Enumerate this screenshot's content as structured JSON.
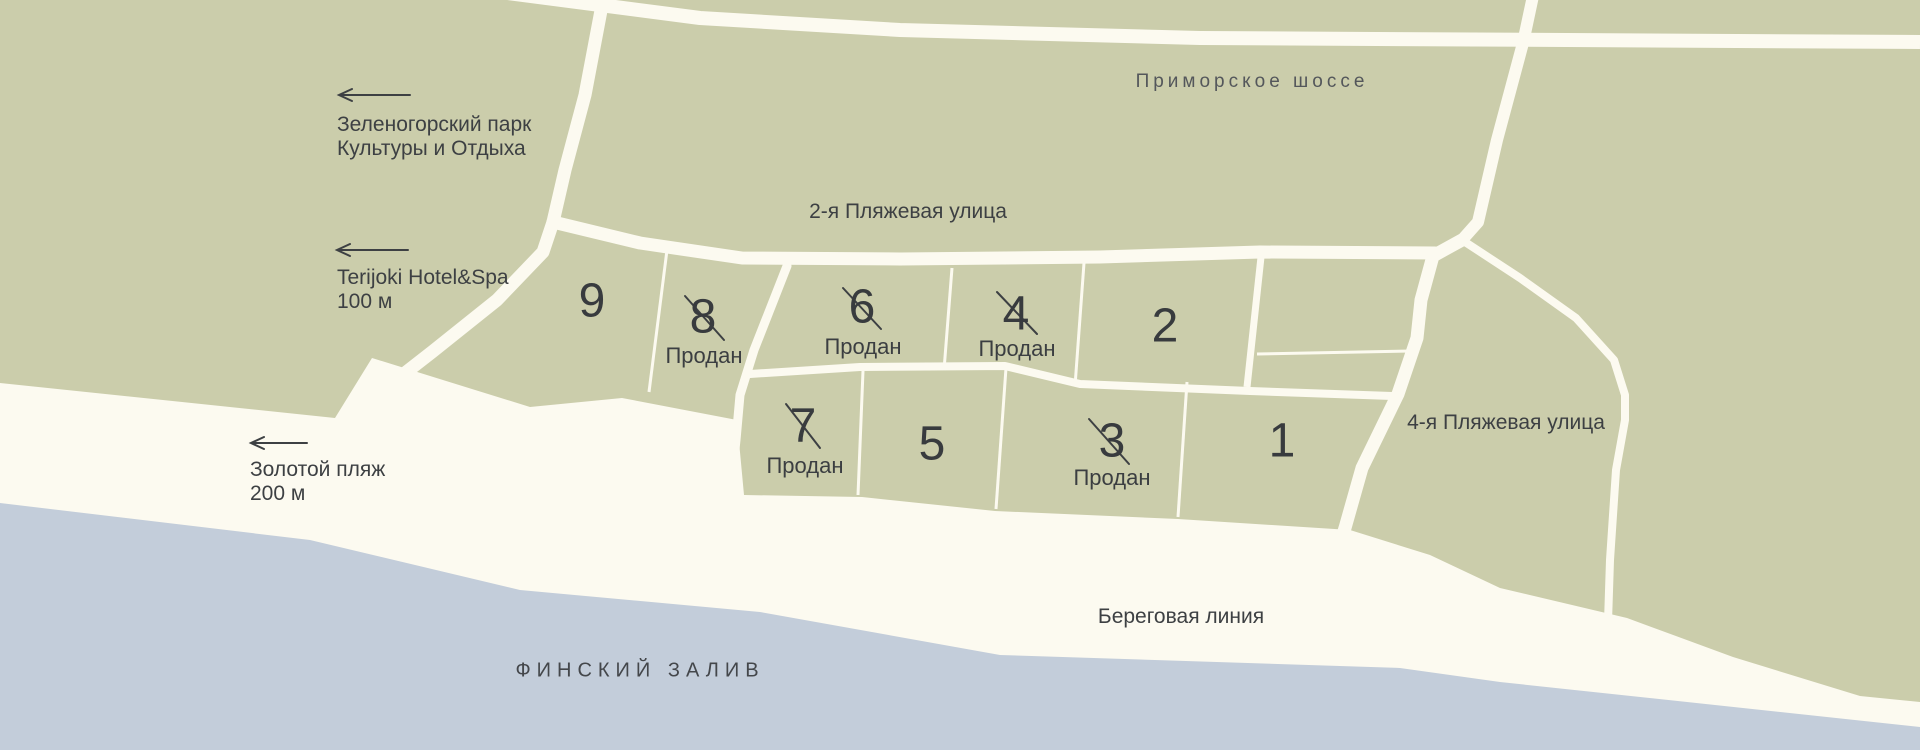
{
  "colors": {
    "land": "#cbcdab",
    "beach": "#fcfaf0",
    "water": "#c3cdda",
    "ink": "#3d4043",
    "road_label": "#54575b"
  },
  "roads": {
    "primorskoye": "Приморское шоссе",
    "beach_street_2": "2-я Пляжевая улица",
    "beach_street_4": "4-я Пляжевая улица"
  },
  "poi": {
    "park": {
      "line1": "Зеленогорский парк",
      "line2": "Культуры и Отдыха"
    },
    "hotel": {
      "line1": "Terijoki Hotel&Spa",
      "line2": "100 м"
    },
    "golden_beach": {
      "line1": "Золотой пляж",
      "line2": "200 м"
    }
  },
  "shore": {
    "shoreline": "Береговая линия",
    "gulf": "ФИНСКИЙ ЗАЛИВ"
  },
  "sold_label": "Продан",
  "plots": [
    {
      "number": "9",
      "sold": false
    },
    {
      "number": "8",
      "sold": true,
      "status": "Продан"
    },
    {
      "number": "6",
      "sold": true,
      "status": "Продан"
    },
    {
      "number": "4",
      "sold": true,
      "status": "Продан"
    },
    {
      "number": "2",
      "sold": false
    },
    {
      "number": "7",
      "sold": true,
      "status": "Продан"
    },
    {
      "number": "5",
      "sold": false
    },
    {
      "number": "3",
      "sold": true,
      "status": "Продан"
    },
    {
      "number": "1",
      "sold": false
    }
  ]
}
